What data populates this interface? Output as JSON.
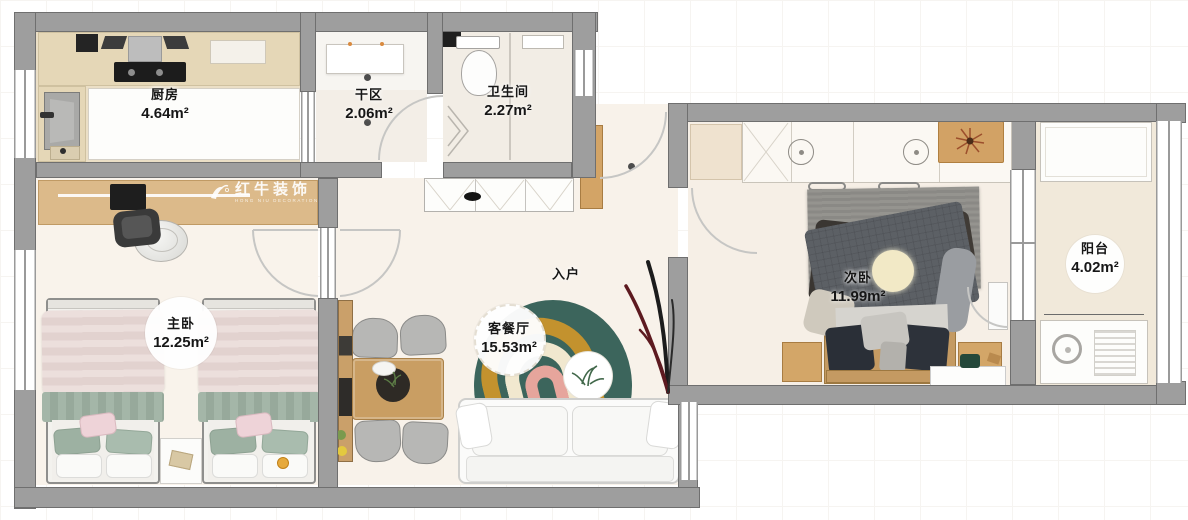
{
  "watermark": {
    "brand": "红牛装饰",
    "tagline": "HONG NIU DECORATION"
  },
  "rooms": {
    "kitchen": {
      "name": "厨房",
      "area": "4.64m²"
    },
    "dry_area": {
      "name": "干区",
      "area": "2.06m²"
    },
    "bathroom": {
      "name": "卫生间",
      "area": "2.27m²"
    },
    "master_bedroom": {
      "name": "主卧",
      "area": "12.25m²"
    },
    "living_dining": {
      "name": "客餐厅",
      "area": "15.53m²"
    },
    "entry": {
      "name": "入户"
    },
    "second_bedroom": {
      "name": "次卧",
      "area": "11.99m²"
    },
    "balcony": {
      "name": "阳台",
      "area": "4.02m²"
    }
  }
}
